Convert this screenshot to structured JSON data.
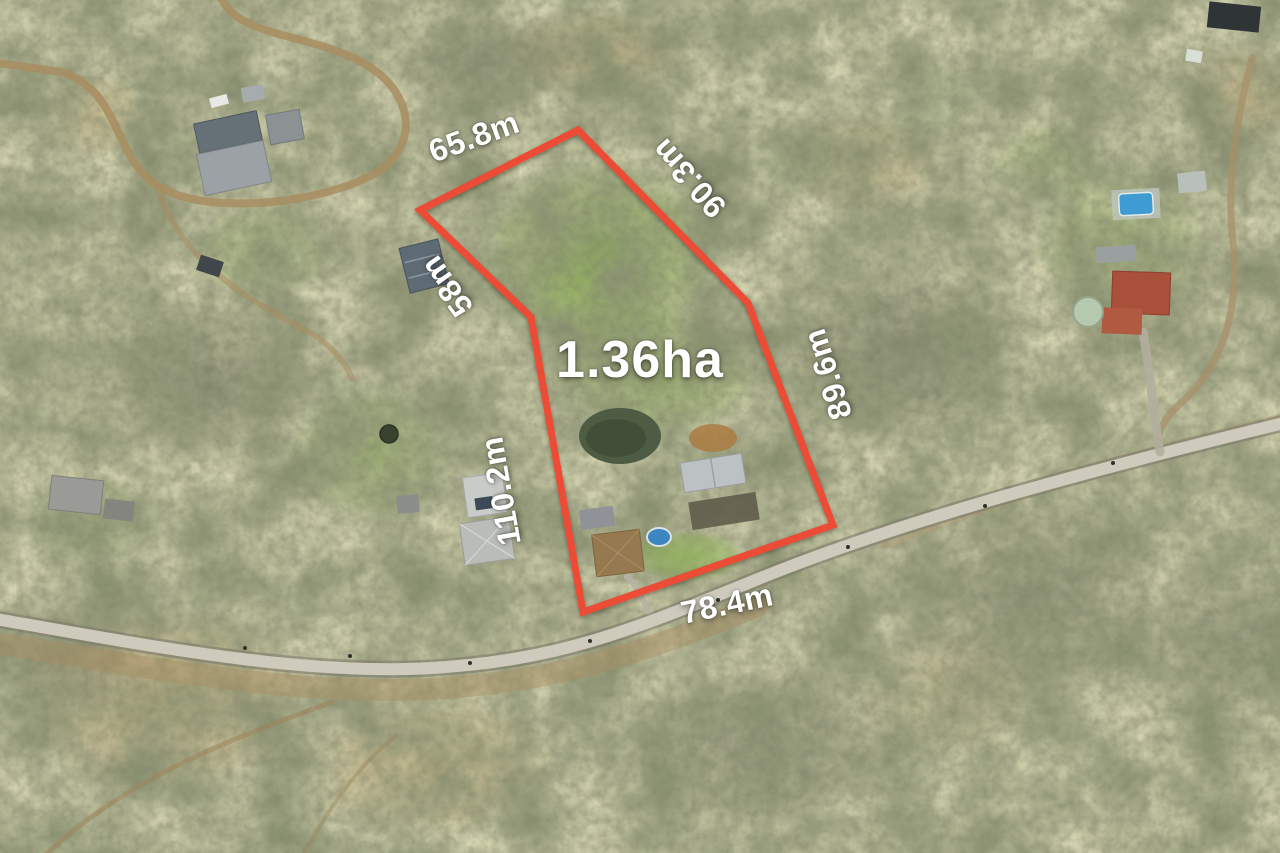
{
  "map": {
    "type": "aerial-photograph",
    "overlay": {
      "boundary_color": "#ec4b34",
      "area_label": "1.36ha",
      "dimensions": [
        {
          "id": "north-west-edge",
          "label": "65.8m"
        },
        {
          "id": "north-east-edge",
          "label": "90.3m"
        },
        {
          "id": "upper-west-edge",
          "label": "58m"
        },
        {
          "id": "east-edge",
          "label": "89.6m"
        },
        {
          "id": "west-edge",
          "label": "110.2m"
        },
        {
          "id": "south-edge",
          "label": "78.4m"
        }
      ]
    }
  }
}
